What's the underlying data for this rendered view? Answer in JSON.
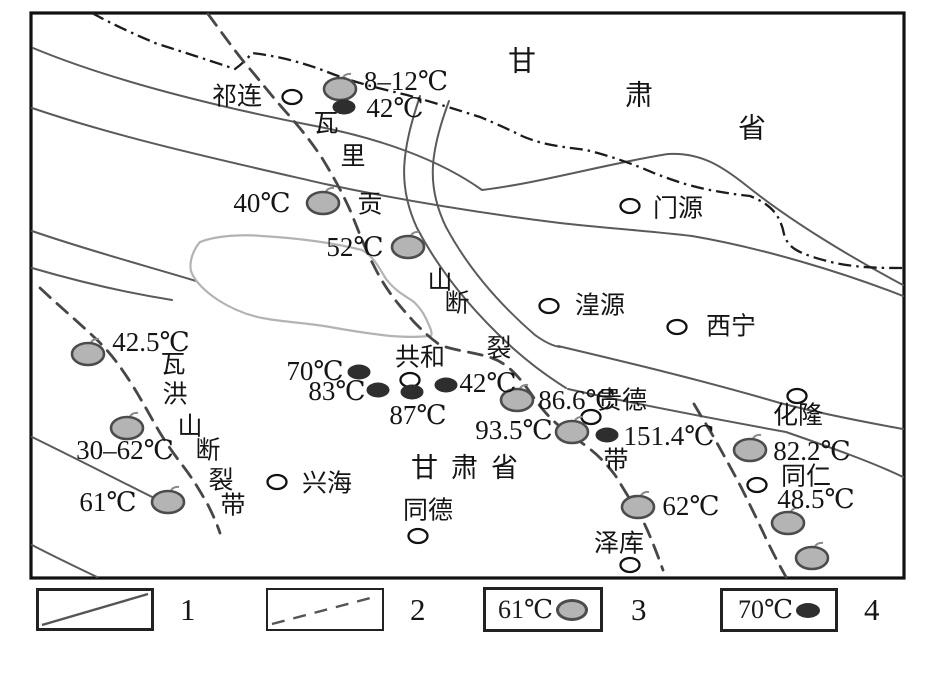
{
  "figure": {
    "title_hidden": "",
    "province_label_top": {
      "name": "甘肃省",
      "chars": [
        {
          "t": "甘",
          "x": 522,
          "y": 62
        },
        {
          "t": "肃",
          "x": 639,
          "y": 96
        },
        {
          "t": "省",
          "x": 752,
          "y": 129
        }
      ]
    },
    "province_label_mid": {
      "text": "甘肃省",
      "x": 471,
      "y": 468
    },
    "cities": [
      {
        "name": "祁连",
        "cx": 292,
        "cy": 97,
        "lx": 237,
        "ly": 97
      },
      {
        "name": "门源",
        "cx": 630,
        "cy": 206,
        "lx": 678,
        "ly": 209
      },
      {
        "name": "湟源",
        "cx": 549,
        "cy": 306,
        "lx": 600,
        "ly": 306
      },
      {
        "name": "西宁",
        "cx": 677,
        "cy": 327,
        "lx": 731,
        "ly": 327
      },
      {
        "name": "共和",
        "cx": 410,
        "cy": 380,
        "lx": 420,
        "ly": 358
      },
      {
        "name": "贵德",
        "cx": 591,
        "cy": 417,
        "lx": 622,
        "ly": 401
      },
      {
        "name": "化隆",
        "cx": 797,
        "cy": 396,
        "lx": 798,
        "ly": 416
      },
      {
        "name": "兴海",
        "cx": 277,
        "cy": 482,
        "lx": 327,
        "ly": 484
      },
      {
        "name": "同德",
        "cx": 418,
        "cy": 536,
        "lx": 428,
        "ly": 511
      },
      {
        "name": "同仁",
        "cx": 757,
        "cy": 485,
        "lx": 806,
        "ly": 477
      },
      {
        "name": "泽库",
        "cx": 630,
        "cy": 565,
        "lx": 619,
        "ly": 544
      }
    ],
    "springs": [
      {
        "temp": "8–12℃",
        "mx": 340,
        "my": 89,
        "lx": 406,
        "ly": 81
      },
      {
        "temp": "40℃",
        "mx": 323,
        "my": 203,
        "lx": 262,
        "ly": 203
      },
      {
        "temp": "52℃",
        "mx": 408,
        "my": 247,
        "lx": 355,
        "ly": 247
      },
      {
        "temp": "42.5℃",
        "mx": 88,
        "my": 354,
        "lx": 151,
        "ly": 342
      },
      {
        "temp": "30–62℃",
        "mx": 127,
        "my": 428,
        "lx": 125,
        "ly": 450
      },
      {
        "temp": "61℃",
        "mx": 168,
        "my": 502,
        "lx": 108,
        "ly": 502
      },
      {
        "temp": "86.6℃",
        "mx": 517,
        "my": 400,
        "lx": 577,
        "ly": 400
      },
      {
        "temp": "93.5℃",
        "mx": 572,
        "my": 432,
        "lx": 514,
        "ly": 430
      },
      {
        "temp": "82.2℃",
        "mx": 750,
        "my": 450,
        "lx": 812,
        "ly": 451
      },
      {
        "temp": "62℃",
        "mx": 638,
        "my": 507,
        "lx": 691,
        "ly": 506
      },
      {
        "temp": "48.5℃",
        "mx": 788,
        "my": 523,
        "lx": 816,
        "ly": 499
      },
      {
        "temp": "",
        "mx": 812,
        "my": 558,
        "lx": 0,
        "ly": 0
      }
    ],
    "wells": [
      {
        "temp": "42℃",
        "mx": 344,
        "my": 107,
        "lx": 395,
        "ly": 108
      },
      {
        "temp": "70℃",
        "mx": 359,
        "my": 372,
        "lx": 315,
        "ly": 371
      },
      {
        "temp": "83℃",
        "mx": 378,
        "my": 390,
        "lx": 337,
        "ly": 391
      },
      {
        "temp": "87℃",
        "mx": 412,
        "my": 392,
        "lx": 418,
        "ly": 415
      },
      {
        "temp": "42℃",
        "mx": 446,
        "my": 385,
        "lx": 488,
        "ly": 383
      },
      {
        "temp": "151.4℃",
        "mx": 607,
        "my": 435,
        "lx": 669,
        "ly": 436
      }
    ],
    "fault_names": [
      {
        "name": "瓦里贡山断裂带",
        "chars": [
          {
            "t": "瓦",
            "x": 326,
            "y": 124
          },
          {
            "t": "里",
            "x": 353,
            "y": 157
          },
          {
            "t": "贡",
            "x": 370,
            "y": 205
          },
          {
            "t": "山",
            "x": 440,
            "y": 281
          },
          {
            "t": "断",
            "x": 457,
            "y": 304
          },
          {
            "t": "裂",
            "x": 499,
            "y": 349
          },
          {
            "t": "带",
            "x": 616,
            "y": 461
          }
        ]
      },
      {
        "name": "瓦洪山断裂带",
        "chars": [
          {
            "t": "瓦",
            "x": 173,
            "y": 365
          },
          {
            "t": "洪",
            "x": 175,
            "y": 395
          },
          {
            "t": "山",
            "x": 190,
            "y": 427
          },
          {
            "t": "断",
            "x": 208,
            "y": 451
          },
          {
            "t": "裂",
            "x": 221,
            "y": 481
          },
          {
            "t": "带",
            "x": 233,
            "y": 506
          }
        ]
      }
    ]
  },
  "legend": {
    "items": [
      {
        "number": "1",
        "kind": "solid-line"
      },
      {
        "number": "2",
        "kind": "dashed-line"
      },
      {
        "number": "3",
        "kind": "hot-spring",
        "temp": "61℃"
      },
      {
        "number": "4",
        "kind": "geothermal-well",
        "temp": "70℃"
      }
    ]
  },
  "colors": {
    "spring_fill": "#b4b4b4",
    "spring_stroke": "#4c4c4c",
    "well_fill": "#2e2e2e",
    "mountain_line": "#5a5a5a",
    "boundary_line": "#1c1c1c",
    "fault_line": "#474747",
    "lake_line": "#b3b3b3",
    "text": "#151515"
  }
}
